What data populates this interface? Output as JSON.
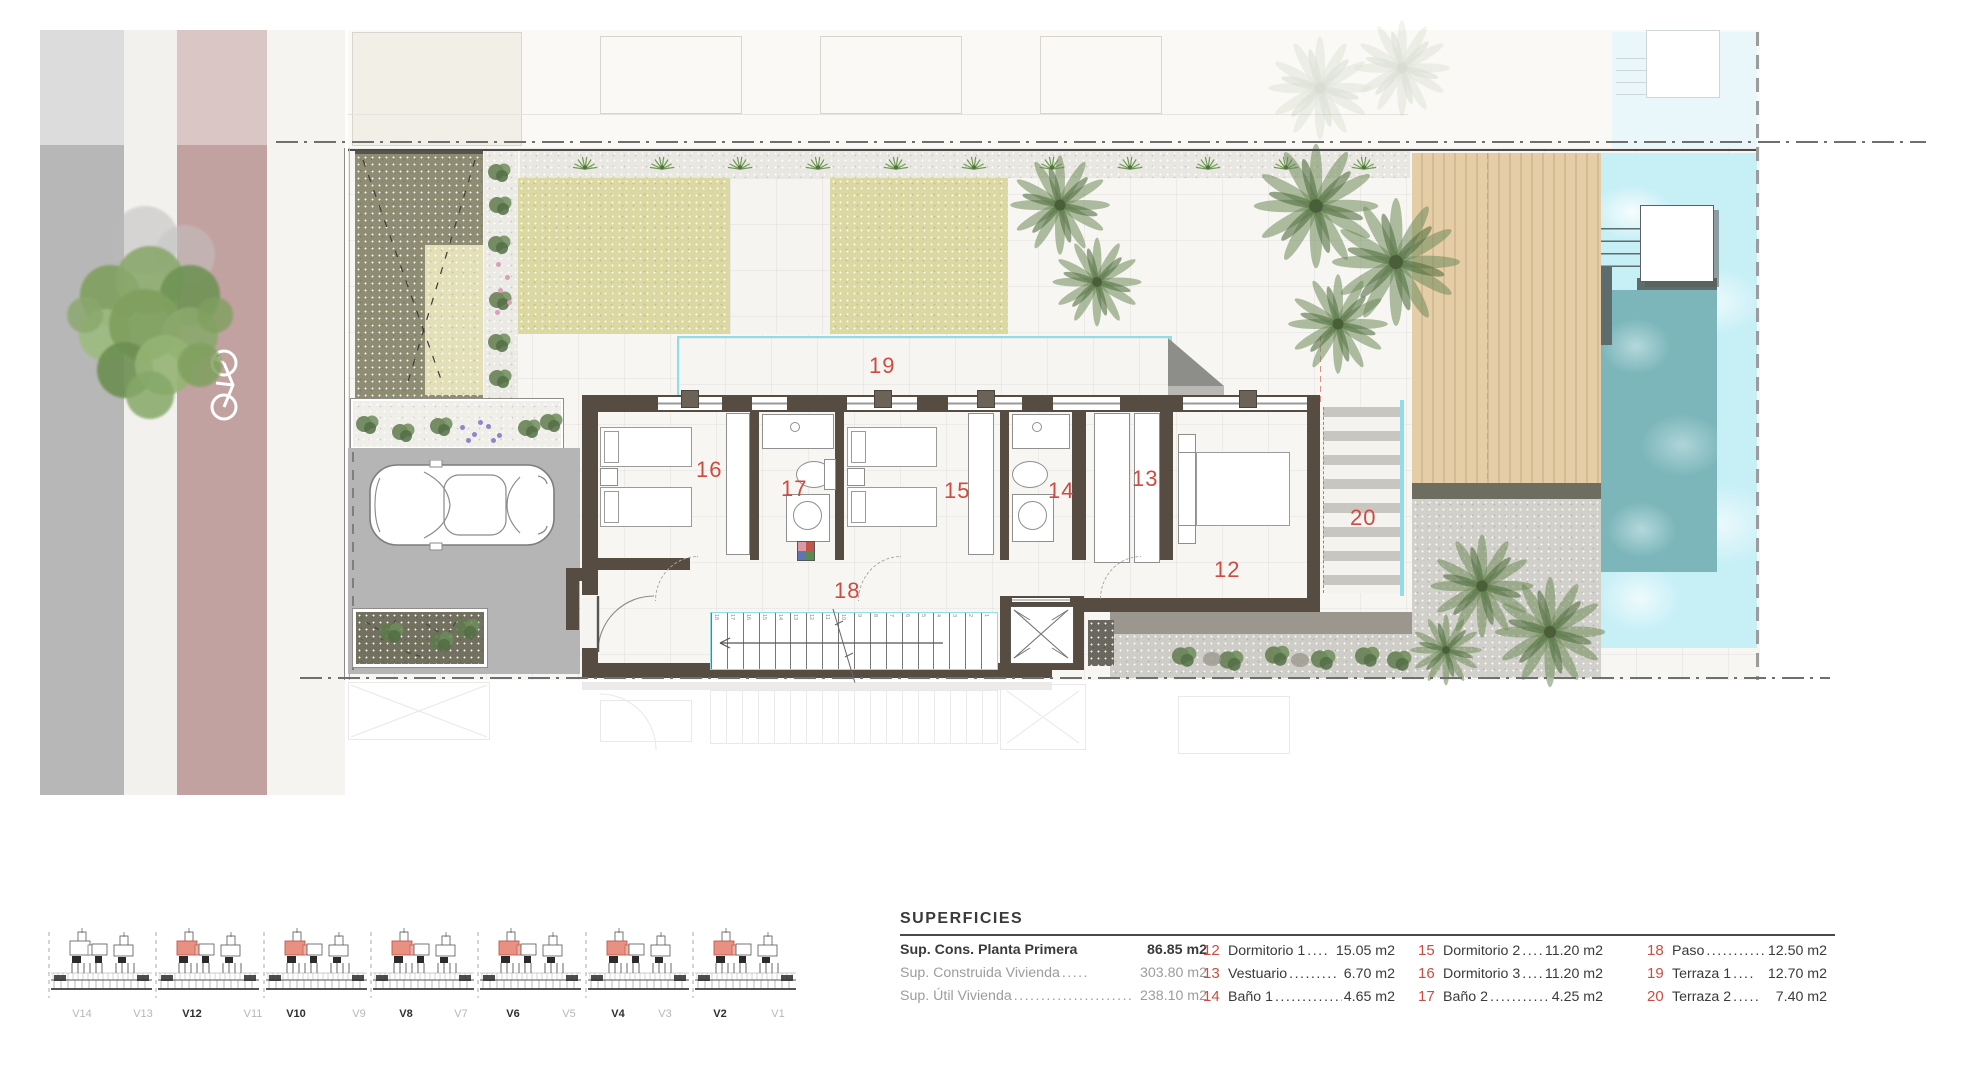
{
  "colors": {
    "accent_red": "#cd4b40",
    "wall": "#574c41",
    "pool_edge": "#8edde9",
    "pool_water": "#c6eff6",
    "pool_inner": "#7cb6ba",
    "bike_lane": "#c2a1a1",
    "asphalt": "#b5b5b5",
    "lawn": "#dbd8a2",
    "olive_garden": "#8e8c73",
    "deck_wood": "#e5cda8",
    "ghost": "#dedbd6"
  },
  "plan": {
    "room_labels": {
      "r12": "12",
      "r13": "13",
      "r14": "14",
      "r15": "15",
      "r16": "16",
      "r17": "17",
      "r18": "18",
      "r19": "19",
      "r20": "20"
    },
    "stairs": {
      "count": 18
    },
    "elevations": {
      "modules": 7,
      "highlight": [
        false,
        true,
        true,
        true,
        true,
        true,
        true
      ],
      "labels": [
        {
          "text": "V14",
          "muted": true
        },
        {
          "text": "V13",
          "muted": true
        },
        {
          "text": "V12",
          "muted": false
        },
        {
          "text": "V11",
          "muted": true
        },
        {
          "text": "V10",
          "muted": false
        },
        {
          "text": "V9",
          "muted": true
        },
        {
          "text": "V8",
          "muted": false
        },
        {
          "text": "V7",
          "muted": true
        },
        {
          "text": "V6",
          "muted": false
        },
        {
          "text": "V5",
          "muted": true
        },
        {
          "text": "V4",
          "muted": false
        },
        {
          "text": "V3",
          "muted": true
        },
        {
          "text": "V2",
          "muted": false
        },
        {
          "text": "V1",
          "muted": true
        }
      ]
    }
  },
  "legend": {
    "title": "SUPERFICIES",
    "summary": [
      {
        "label": "Sup. Cons. Planta Primera",
        "dots": "",
        "value": "86.85 m2"
      },
      {
        "label": "Sup. Construida Vivienda",
        "dots": ".....",
        "value": "303.80 m2"
      },
      {
        "label": "Sup. Útil Vivienda",
        "dots": "......................",
        "value": "238.10 m2"
      }
    ],
    "columns": [
      [
        {
          "num": "12",
          "name": "Dormitorio 1",
          "dots": "....",
          "value": "15.05 m2"
        },
        {
          "num": "13",
          "name": "Vestuario",
          "dots": ".........",
          "value": "6.70 m2"
        },
        {
          "num": "14",
          "name": "Baño 1",
          "dots": "................",
          "value": "4.65 m2"
        }
      ],
      [
        {
          "num": "15",
          "name": "Dormitorio 2",
          "dots": ".....",
          "value": "11.20 m2"
        },
        {
          "num": "16",
          "name": "Dormitorio 3",
          "dots": ".....",
          "value": "11.20 m2"
        },
        {
          "num": "17",
          "name": "Baño 2",
          "dots": "................",
          "value": "4.25 m2"
        }
      ],
      [
        {
          "num": "18",
          "name": "Paso",
          "dots": "..............",
          "value": "12.50 m2"
        },
        {
          "num": "19",
          "name": "Terraza 1",
          "dots": "....",
          "value": "12.70 m2"
        },
        {
          "num": "20",
          "name": "Terraza 2",
          "dots": ".....",
          "value": "7.40 m2"
        }
      ]
    ]
  }
}
